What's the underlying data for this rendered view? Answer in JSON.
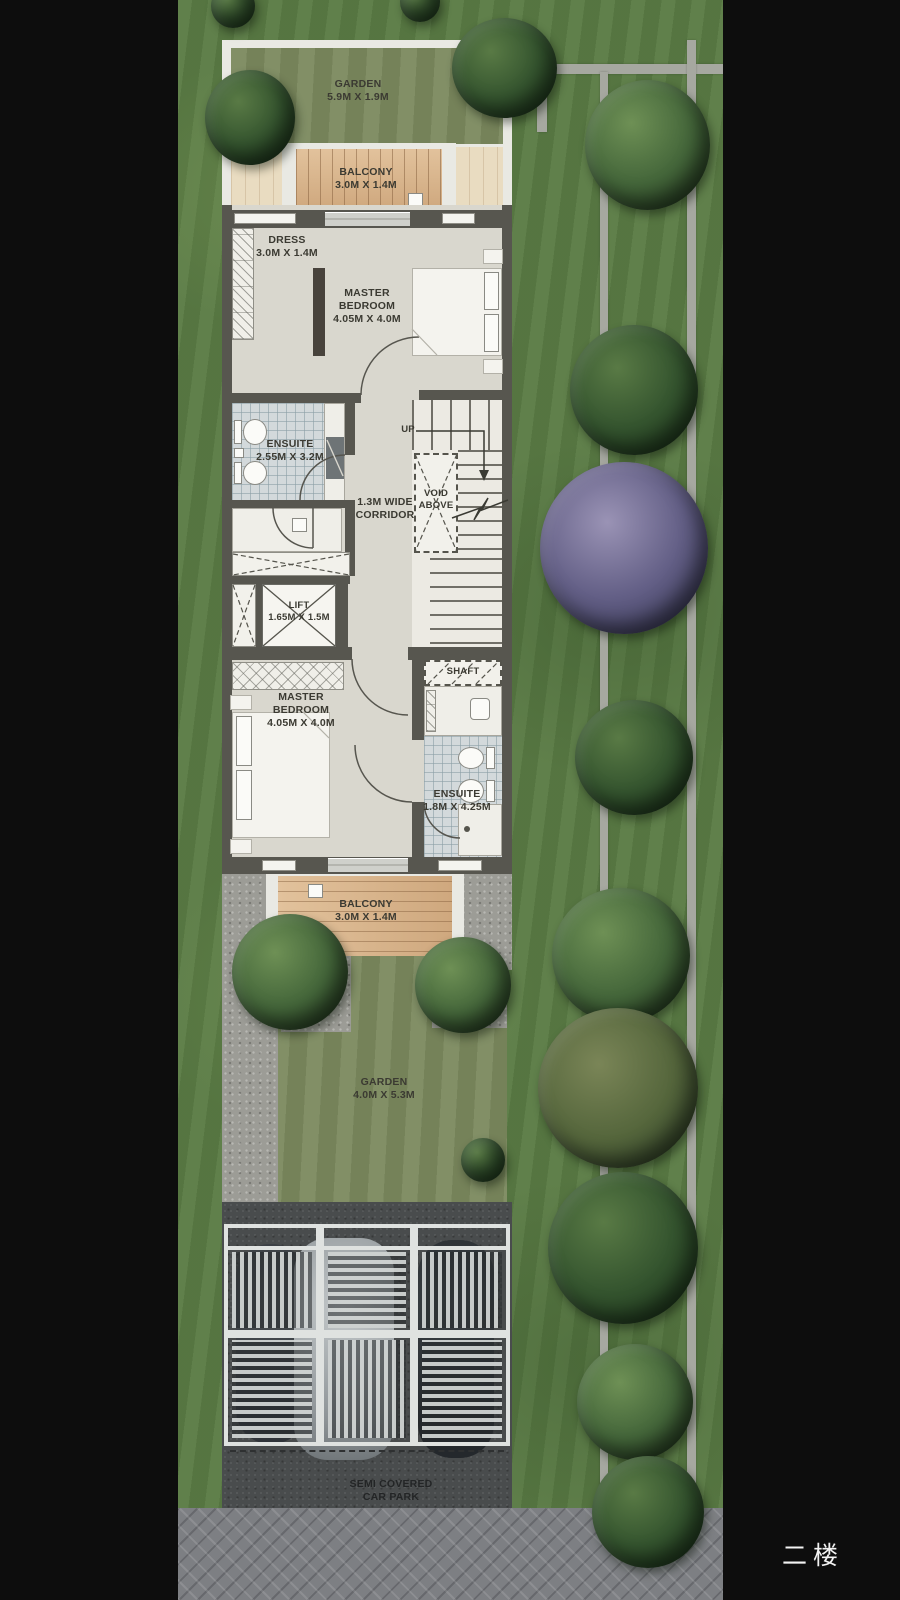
{
  "floor_tag": "二楼",
  "rooms": {
    "garden_top": {
      "name": "GARDEN",
      "dims": "5.9M X 1.9M"
    },
    "balcony_top": {
      "name": "BALCONY",
      "dims": "3.0M X 1.4M"
    },
    "dress": {
      "name": "DRESS",
      "dims": "3.0M X 1.4M"
    },
    "master_bedroom_1": {
      "name1": "MASTER",
      "name2": "BEDROOM",
      "dims": "4.05M X 4.0M"
    },
    "ensuite_1": {
      "name": "ENSUITE",
      "dims": "2.55M X 3.2M"
    },
    "corridor": {
      "line1": "1.3M WIDE",
      "line2": "CORRIDOR"
    },
    "void": {
      "line1": "VOID",
      "line2": "ABOVE"
    },
    "stairs": {
      "up": "UP"
    },
    "lift": {
      "name": "LIFT",
      "dims": "1.65M X 1.5M"
    },
    "shaft": {
      "name": "SHAFT"
    },
    "master_bedroom_2": {
      "name1": "MASTER",
      "name2": "BEDROOM",
      "dims": "4.05M X 4.0M"
    },
    "ensuite_2": {
      "name": "ENSUITE",
      "dims": "1.8M X 4.25M"
    },
    "balcony_bottom": {
      "name": "BALCONY",
      "dims": "3.0M X 1.4M"
    },
    "garden_bottom": {
      "name": "GARDEN",
      "dims": "4.0M X 5.3M"
    },
    "car_park": {
      "line1": "SEMI COVERED",
      "line2": "CAR PARK"
    }
  },
  "colors": {
    "background": "#0d0d0d",
    "grass": "#5a7b44",
    "plan_floor": "#d9d7ce",
    "wall": "#57564f",
    "wood_deck": "#d9b68d",
    "tile": "#d3d9db",
    "asphalt": "#494c4d",
    "paver_road": "#7d7f83",
    "garden": "#7b895e"
  }
}
